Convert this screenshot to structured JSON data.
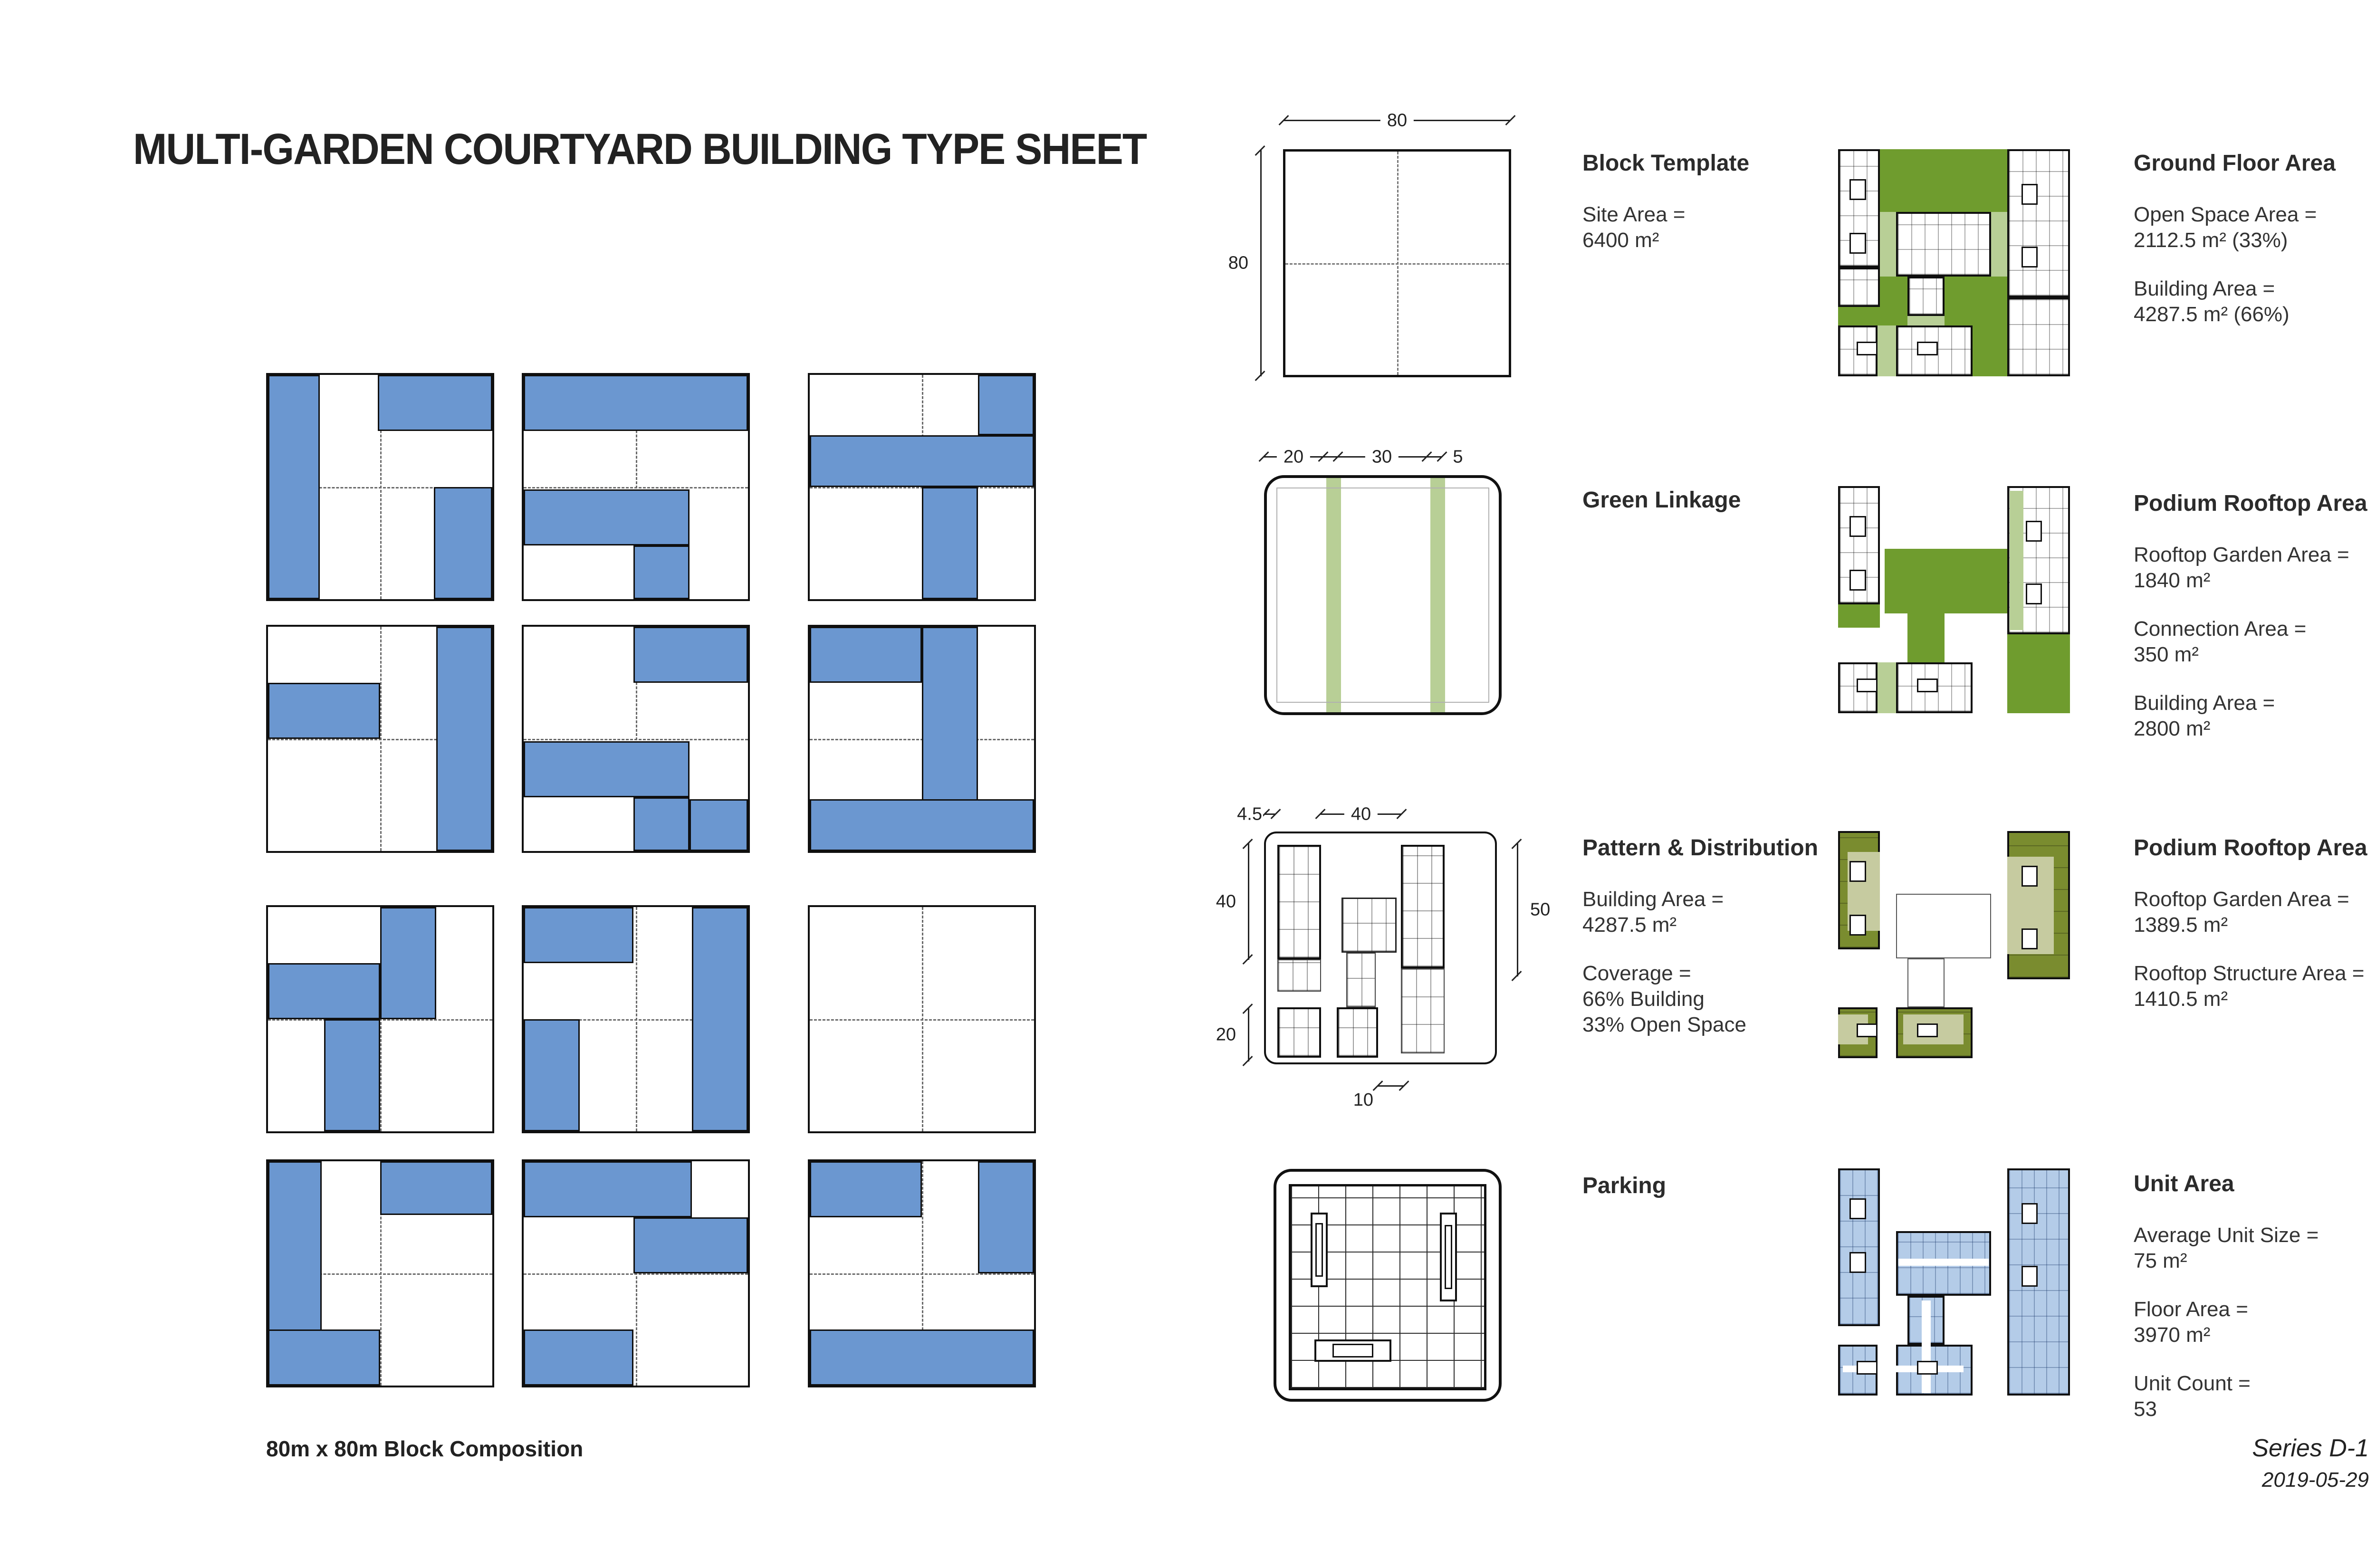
{
  "title": "MULTI-GARDEN COURTYARD BUILDING TYPE SHEET",
  "composition_label": "80m x 80m Block Composition",
  "footer": {
    "series": "Series D-1",
    "date": "2019-05-29"
  },
  "colors": {
    "building_blue": "#6b97d0",
    "garden_green": "#6f9c2e",
    "linkage_light_green": "#b8cf96",
    "rooftop_olive": "#7a8c2f",
    "rooftop_sage": "#c6cba0",
    "unit_light_blue": "#b4cce8"
  },
  "tiles": [
    [
      [
        0,
        0,
        23,
        100
      ],
      [
        49,
        0,
        51,
        25
      ],
      [
        74,
        50,
        26,
        50
      ]
    ],
    [
      [
        0,
        0,
        100,
        25
      ],
      [
        0,
        51,
        74,
        25
      ],
      [
        49,
        76,
        25,
        24
      ]
    ],
    [
      [
        75,
        0,
        25,
        27
      ],
      [
        0,
        27,
        100,
        23
      ],
      [
        50,
        50,
        25,
        50
      ]
    ],
    [
      [
        0,
        25,
        50,
        25
      ],
      [
        75,
        0,
        25,
        100
      ]
    ],
    [
      [
        49,
        0,
        51,
        25
      ],
      [
        0,
        51,
        74,
        25
      ],
      [
        49,
        76,
        25,
        24
      ],
      [
        74,
        77,
        26,
        23
      ]
    ],
    [
      [
        0,
        0,
        50,
        25
      ],
      [
        50,
        0,
        25,
        100
      ],
      [
        0,
        77,
        100,
        23
      ]
    ],
    [
      [
        50,
        0,
        25,
        50
      ],
      [
        0,
        25,
        50,
        25
      ],
      [
        25,
        50,
        25,
        50
      ]
    ],
    [
      [
        0,
        0,
        49,
        25
      ],
      [
        75,
        0,
        25,
        100
      ],
      [
        0,
        50,
        25,
        50
      ]
    ],
    [],
    [
      [
        0,
        0,
        24,
        100
      ],
      [
        0,
        75,
        50,
        25
      ],
      [
        50,
        0,
        50,
        24
      ]
    ],
    [
      [
        0,
        0,
        75,
        25
      ],
      [
        49,
        25,
        51,
        25
      ],
      [
        0,
        75,
        49,
        25
      ]
    ],
    [
      [
        0,
        0,
        50,
        25
      ],
      [
        75,
        0,
        25,
        50
      ],
      [
        0,
        75,
        100,
        25
      ]
    ]
  ],
  "panels": {
    "block_template": {
      "label": "Block Template",
      "groups": [
        [
          "Site Area =",
          "6400 m²"
        ]
      ],
      "dims": {
        "top": "80",
        "left": "80"
      }
    },
    "green_linkage": {
      "label": "Green Linkage",
      "dims": [
        "20",
        "30",
        "5"
      ]
    },
    "pattern": {
      "label": "Pattern & Distribution",
      "groups": [
        [
          "Building Area =",
          "4287.5 m²"
        ],
        [
          "Coverage =",
          "66% Building",
          "33% Open Space"
        ]
      ],
      "dims": {
        "top_margin": "4.5",
        "top": "40",
        "right": "50",
        "left_upper": "40",
        "left_lower": "20",
        "bottom": "10"
      }
    },
    "parking": {
      "label": "Parking"
    },
    "ground_floor": {
      "label": "Ground Floor Area",
      "groups": [
        [
          "Open Space Area =",
          "2112.5 m² (33%)"
        ],
        [
          "Building Area =",
          "4287.5 m² (66%)"
        ]
      ]
    },
    "podium1": {
      "label": "Podium Rooftop Area",
      "groups": [
        [
          "Rooftop Garden Area =",
          "1840 m²"
        ],
        [
          "Connection Area =",
          "350 m²"
        ],
        [
          "Building Area =",
          "2800 m²"
        ]
      ]
    },
    "podium2": {
      "label": "Podium Rooftop Area",
      "groups": [
        [
          "Rooftop Garden Area =",
          "1389.5 m²"
        ],
        [
          "Rooftop Structure Area =",
          "1410.5 m²"
        ]
      ]
    },
    "unit": {
      "label": "Unit Area",
      "groups": [
        [
          "Average Unit Size =",
          "75 m²"
        ],
        [
          "Floor Area =",
          "3970 m²"
        ],
        [
          "Unit Count =",
          "53"
        ]
      ]
    }
  },
  "plans": {
    "pattern": {
      "rects": [
        {
          "c": "pfb",
          "r": [
            5,
            5,
            19,
            50
          ]
        },
        {
          "c": "pft",
          "r": [
            5,
            55,
            19,
            14
          ]
        },
        {
          "c": "pfm",
          "r": [
            33,
            28,
            24,
            24
          ]
        },
        {
          "c": "pft",
          "r": [
            35,
            52,
            13,
            24
          ]
        },
        {
          "c": "pfb",
          "r": [
            31,
            76,
            18,
            22
          ]
        },
        {
          "c": "pfb",
          "r": [
            5,
            76,
            19,
            22
          ]
        },
        {
          "c": "pfb",
          "r": [
            59,
            5,
            19,
            54
          ]
        },
        {
          "c": "pft",
          "r": [
            59,
            59,
            19,
            37
          ]
        }
      ]
    },
    "parking": {
      "cores": [
        [
          10,
          13,
          9,
          37
        ],
        [
          77,
          13,
          9,
          44
        ],
        [
          12,
          76,
          40,
          11
        ]
      ]
    },
    "ground_floor": {
      "rects": [
        {
          "c": "green",
          "r": [
            18,
            0,
            55,
            27
          ]
        },
        {
          "c": "green",
          "r": [
            18,
            55,
            12,
            22
          ]
        },
        {
          "c": "green",
          "r": [
            0,
            68,
            18,
            8
          ]
        },
        {
          "c": "green",
          "r": [
            46,
            55,
            27,
            43
          ]
        },
        {
          "c": "sage",
          "r": [
            18,
            27,
            7,
            28
          ]
        },
        {
          "c": "sage",
          "r": [
            66,
            27,
            7,
            28
          ]
        },
        {
          "c": "sage",
          "r": [
            17,
            76,
            8,
            22
          ]
        },
        {
          "c": "sage",
          "r": [
            30,
            72,
            16,
            5
          ]
        },
        {
          "c": "bldg",
          "r": [
            0,
            0,
            18,
            51
          ]
        },
        {
          "c": "bldg",
          "r": [
            0,
            51,
            18,
            17
          ]
        },
        {
          "c": "bldg",
          "r": [
            25,
            27,
            41,
            28
          ]
        },
        {
          "c": "bldg",
          "r": [
            30,
            55,
            16,
            17
          ]
        },
        {
          "c": "bldg",
          "r": [
            25,
            76,
            33,
            22
          ]
        },
        {
          "c": "bldg",
          "r": [
            0,
            76,
            17,
            22
          ]
        },
        {
          "c": "bldg",
          "r": [
            73,
            0,
            27,
            64
          ]
        },
        {
          "c": "bldg",
          "r": [
            73,
            64,
            27,
            34
          ]
        },
        {
          "c": "core",
          "r": [
            5,
            13,
            7,
            9
          ]
        },
        {
          "c": "core",
          "r": [
            5,
            36,
            7,
            9
          ]
        },
        {
          "c": "core",
          "r": [
            79,
            15,
            7,
            9
          ]
        },
        {
          "c": "core",
          "r": [
            79,
            42,
            7,
            9
          ]
        },
        {
          "c": "core",
          "r": [
            8,
            83,
            9,
            6
          ]
        },
        {
          "c": "core",
          "r": [
            34,
            83,
            9,
            6
          ]
        }
      ]
    },
    "podium1": {
      "rects": [
        {
          "c": "green",
          "r": [
            20,
            27,
            53,
            28
          ]
        },
        {
          "c": "green",
          "r": [
            30,
            55,
            16,
            21
          ]
        },
        {
          "c": "green",
          "r": [
            0,
            51,
            18,
            10
          ]
        },
        {
          "c": "green",
          "r": [
            73,
            64,
            27,
            34
          ]
        },
        {
          "c": "bldg",
          "r": [
            0,
            0,
            18,
            51
          ]
        },
        {
          "c": "bldg",
          "r": [
            73,
            0,
            27,
            64
          ]
        },
        {
          "c": "sage",
          "r": [
            74,
            2,
            6,
            60
          ]
        },
        {
          "c": "bldg",
          "r": [
            25,
            76,
            33,
            22
          ]
        },
        {
          "c": "bldg",
          "r": [
            0,
            76,
            17,
            22
          ]
        },
        {
          "c": "sage",
          "r": [
            17,
            76,
            8,
            22
          ]
        },
        {
          "c": "core",
          "r": [
            5,
            13,
            7,
            9
          ]
        },
        {
          "c": "core",
          "r": [
            5,
            36,
            7,
            9
          ]
        },
        {
          "c": "core",
          "r": [
            81,
            15,
            7,
            9
          ]
        },
        {
          "c": "core",
          "r": [
            81,
            42,
            7,
            9
          ]
        },
        {
          "c": "core",
          "r": [
            8,
            83,
            9,
            6
          ]
        },
        {
          "c": "core",
          "r": [
            34,
            83,
            9,
            6
          ]
        }
      ]
    },
    "podium2": {
      "rects": [
        {
          "c": "outline",
          "r": [
            25,
            27,
            41,
            28
          ]
        },
        {
          "c": "outline",
          "r": [
            30,
            55,
            16,
            21
          ]
        },
        {
          "c": "olive",
          "r": [
            0,
            0,
            18,
            51
          ]
        },
        {
          "c": "sage2",
          "r": [
            4,
            9,
            14,
            34
          ]
        },
        {
          "c": "olive",
          "r": [
            73,
            0,
            27,
            64
          ]
        },
        {
          "c": "sage2",
          "r": [
            73,
            11,
            20,
            42
          ]
        },
        {
          "c": "olive",
          "r": [
            25,
            76,
            33,
            22
          ]
        },
        {
          "c": "sage2",
          "r": [
            28,
            79,
            26,
            13
          ]
        },
        {
          "c": "olive",
          "r": [
            0,
            76,
            17,
            22
          ]
        },
        {
          "c": "sage2",
          "r": [
            0,
            79,
            13,
            13
          ]
        },
        {
          "c": "core",
          "r": [
            5,
            13,
            7,
            9
          ]
        },
        {
          "c": "core",
          "r": [
            5,
            36,
            7,
            9
          ]
        },
        {
          "c": "core",
          "r": [
            79,
            15,
            7,
            9
          ]
        },
        {
          "c": "core",
          "r": [
            79,
            42,
            7,
            9
          ]
        },
        {
          "c": "core",
          "r": [
            8,
            83,
            9,
            6
          ]
        },
        {
          "c": "core",
          "r": [
            34,
            83,
            9,
            6
          ]
        }
      ]
    },
    "unit": {
      "rects": [
        {
          "c": "blue",
          "r": [
            0,
            0,
            18,
            68
          ]
        },
        {
          "c": "blue",
          "r": [
            73,
            0,
            27,
            98
          ]
        },
        {
          "c": "blue",
          "r": [
            25,
            27,
            41,
            28
          ]
        },
        {
          "c": "blue",
          "r": [
            30,
            55,
            16,
            21
          ]
        },
        {
          "c": "blue",
          "r": [
            25,
            76,
            33,
            22
          ]
        },
        {
          "c": "blue",
          "r": [
            0,
            76,
            17,
            22
          ]
        },
        {
          "c": "wline",
          "r": [
            26,
            39,
            39,
            3
          ]
        },
        {
          "c": "wline",
          "r": [
            36,
            57,
            4,
            40
          ]
        },
        {
          "c": "wline",
          "r": [
            2,
            85,
            52,
            3
          ]
        },
        {
          "c": "core",
          "r": [
            5,
            13,
            7,
            9
          ]
        },
        {
          "c": "core",
          "r": [
            5,
            36,
            7,
            9
          ]
        },
        {
          "c": "core",
          "r": [
            79,
            15,
            7,
            9
          ]
        },
        {
          "c": "core",
          "r": [
            79,
            42,
            7,
            9
          ]
        },
        {
          "c": "core",
          "r": [
            8,
            83,
            9,
            6
          ]
        },
        {
          "c": "core",
          "r": [
            34,
            83,
            9,
            6
          ]
        }
      ]
    }
  }
}
